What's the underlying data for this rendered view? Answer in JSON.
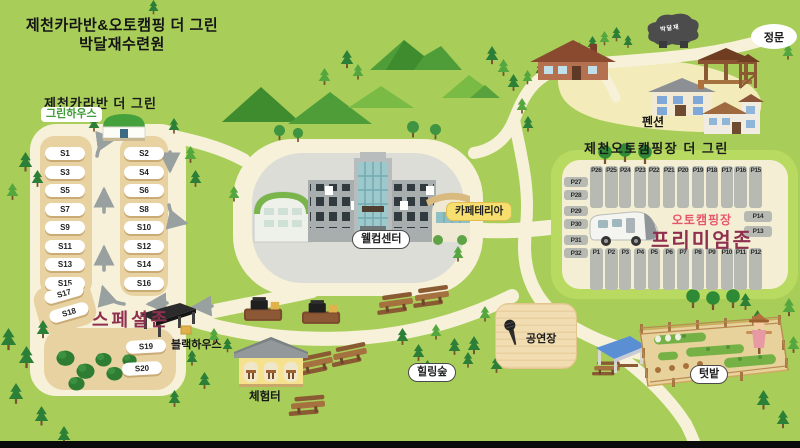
{
  "title": {
    "line1": "제천카라반&오토캠핑 더 그린",
    "line2": "박달재수련원"
  },
  "caravan_zone": {
    "section_title": "제천카라반 더 그린",
    "greenhouse_label": "그린하우스",
    "zone_label": "스페셜존",
    "blackhouse_label": "블랙하우스",
    "left_column_slots": [
      "S1",
      "S3",
      "S5",
      "S7",
      "S9",
      "S11",
      "S13",
      "S15"
    ],
    "right_column_slots": [
      "S2",
      "S4",
      "S6",
      "S8",
      "S10",
      "S12",
      "S14",
      "S16"
    ],
    "diagonal_slots": [
      "S17",
      "S18"
    ],
    "lower_slots": [
      "S19",
      "S20"
    ]
  },
  "center_area": {
    "welcome_center_label": "웰컴센터",
    "cafeteria_label": "카페테리아"
  },
  "auto_camp_zone": {
    "section_title": "제천오토캠핑장 더 그린",
    "zone_subtitle": "오토캠핑장",
    "zone_title": "프리미엄존",
    "top_row_slots": [
      "P26",
      "P25",
      "P24",
      "P23",
      "P22",
      "P21",
      "P20",
      "P19",
      "P18",
      "P17",
      "P16",
      "P15"
    ],
    "bottom_row_slots": [
      "P1",
      "P2",
      "P3",
      "P4",
      "P5",
      "P6",
      "P7",
      "P8",
      "P9",
      "P10",
      "P11",
      "P12"
    ],
    "left_column_slots": [
      "P27",
      "P28",
      "P29",
      "P30",
      "P31",
      "P32"
    ],
    "right_column_slots": [
      "P14",
      "P13"
    ]
  },
  "landmarks": {
    "main_gate": "정문",
    "monument": "박달재",
    "pension": "펜션",
    "experience_area": "체험터",
    "healing_forest": "힐링숲",
    "stage": "공연장",
    "garden": "텃밭"
  },
  "icons": {
    "tree": "tree-icon",
    "bush": "bush-icon",
    "mountain": "mountain-icon",
    "caravan": "caravan-icon",
    "microphone": "microphone-icon",
    "scarecrow": "scarecrow-icon",
    "picnic_table": "picnic-table-icon",
    "bbq_grill": "bbq-grill-icon",
    "direction_arrow": "direction-arrow-icon"
  },
  "colors": {
    "background": "#a8ce59",
    "road": "#f7f1da",
    "zone_tan": "#e8d2a2",
    "lot_gray": "#dcddd7",
    "premium_green": "#b9da60",
    "premium_cream": "#f4efd4",
    "slot_gray": "#b6bab2",
    "maroon_text": "#8e2f4e",
    "pink_text": "#e8566b",
    "cafeteria_yellow": "#f6df6e"
  }
}
